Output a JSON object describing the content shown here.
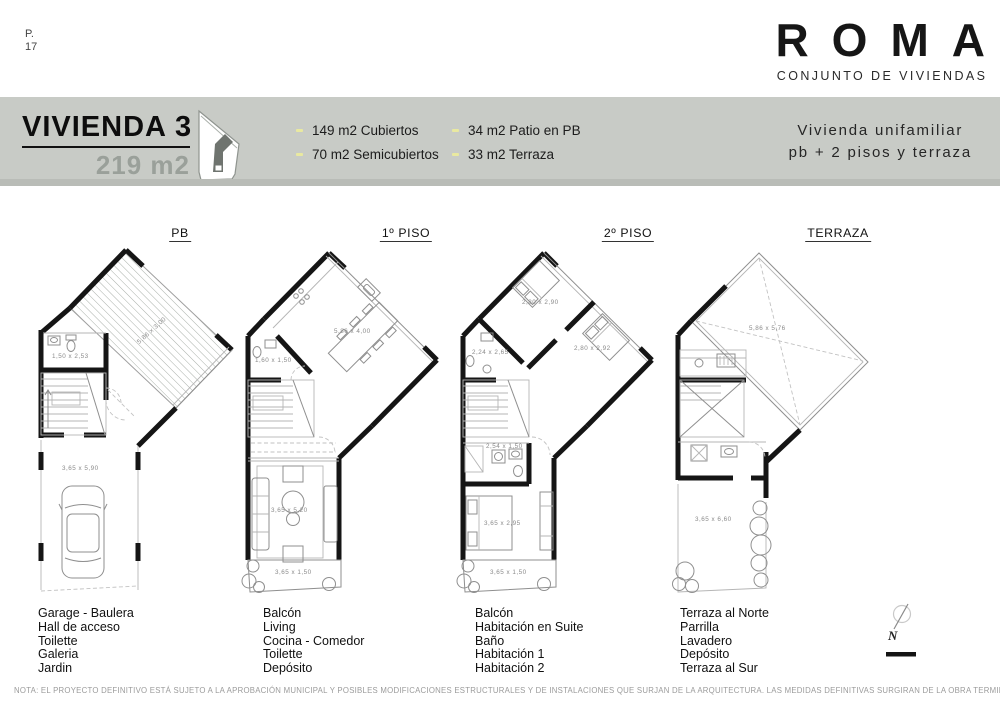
{
  "page": {
    "code": "P.",
    "number": "17"
  },
  "brand": {
    "name": "ROMA",
    "subtitle": "CONJUNTO DE VIVIENDAS"
  },
  "header": {
    "title": "VIVIENDA 3",
    "area": "219 m2",
    "specs": [
      "149 m2 Cubiertos",
      "70 m2 Semicubiertos",
      "34 m2 Patio en PB",
      "33 m2 Terraza"
    ],
    "type_line1": "Vivienda unifamiliar",
    "type_line2": "pb + 2 pisos y terraza",
    "band_color": "#c8cbc6",
    "bullet_color": "#e9e9a0"
  },
  "plans": [
    {
      "label": "PB",
      "dims": [
        "5,86 x 3,00",
        "1,50 x 2,53",
        "3,65 x 5,90"
      ],
      "rooms": [
        "Garage - Baulera",
        "Hall de acceso",
        "Toilette",
        "Galeria",
        "Jardin"
      ]
    },
    {
      "label": "1º PISO",
      "dims": [
        "5,86 x 4,00",
        "1,60 x 1,50",
        "3,65 x 5,20",
        "3,65 x 1,50"
      ],
      "rooms": [
        "Balcón",
        "Living",
        "Cocina - Comedor",
        "Toilette",
        "Depósito"
      ]
    },
    {
      "label": "2º PISO",
      "dims": [
        "2,80 x 2,90",
        "2,24 x 2,65",
        "2,80 x 2,92",
        "2,54 x 1,50",
        "3,65 x 2,95",
        "3,65 x 1,50"
      ],
      "rooms": [
        "Balcón",
        "Habitación en Suite",
        "Baño",
        "Habitación 1",
        "Habitación 2"
      ]
    },
    {
      "label": "TERRAZA",
      "dims": [
        "5,86 x 5,76",
        "3,65 x 6,60"
      ],
      "rooms": [
        "Terraza al Norte",
        "Parrilla",
        "Lavadero",
        "Depósito",
        "Terraza al Sur"
      ]
    }
  ],
  "compass": {
    "north": "N"
  },
  "note": "NOTA: EL PROYECTO DEFINITIVO ESTÁ SUJETO A LA APROBACIÓN MUNICIPAL Y POSIBLES MODIFICACIONES ESTRUCTURALES Y DE INSTALACIONES QUE SURJAN DE LA ARQUITECTURA. LAS MEDIDAS DEFINITIVAS SURGIRAN DE LA OBRA TERMINADA"
}
